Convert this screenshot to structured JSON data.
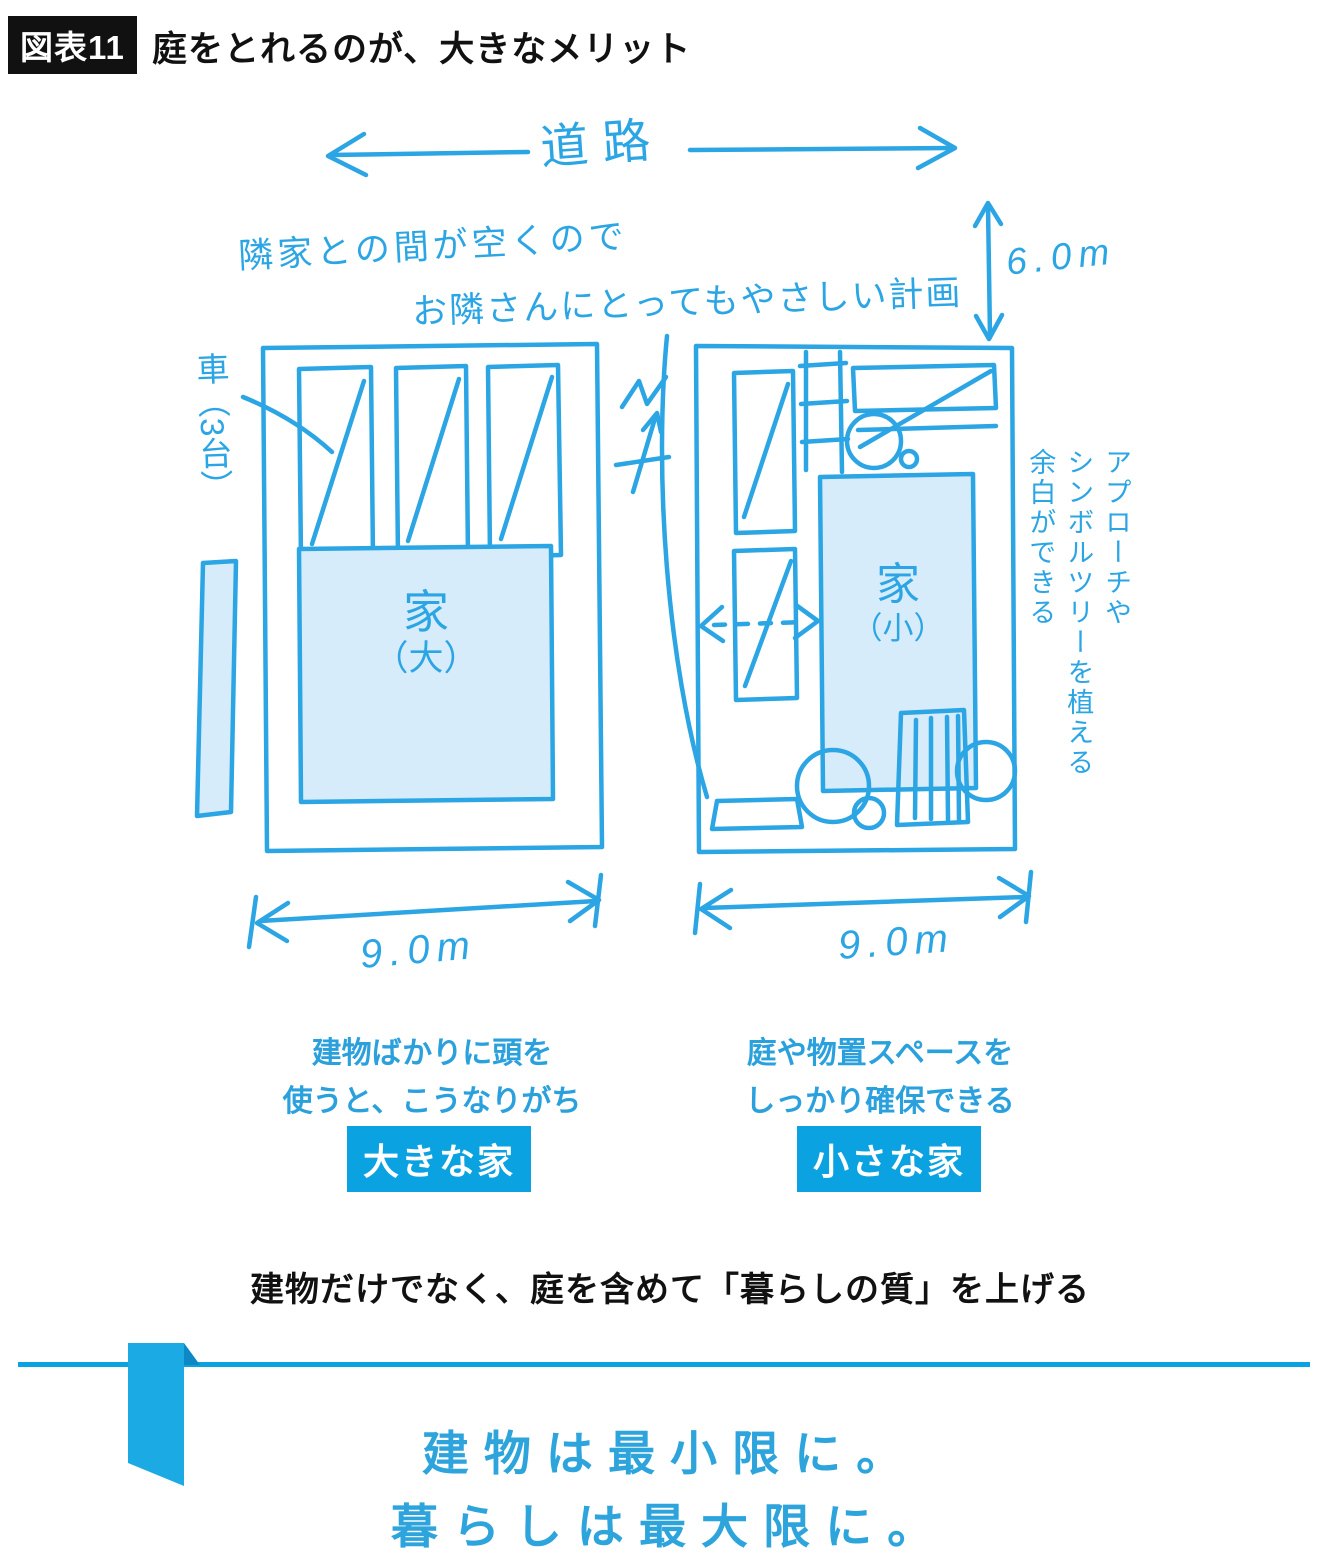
{
  "colors": {
    "sketch_blue": "#2ba5e4",
    "light_fill": "#d7ecfa",
    "accent_blue": "#0aa2e0",
    "text_dark": "#111111"
  },
  "header": {
    "badge": "図表11",
    "title": "庭をとれるのが、大きなメリット"
  },
  "diagram": {
    "road_label": "道路",
    "note_line1": "隣家との間が空くので",
    "note_line2": "お隣さんにとってもやさしい計画",
    "dim_vertical": "6.0m",
    "car_label": "車（3台）",
    "house_large_line1": "家",
    "house_large_line2": "（大）",
    "house_small_line1": "家",
    "house_small_line2": "（小）",
    "side_note_line1": "アプローチや",
    "side_note_line2": "シンボルツリーを植える",
    "side_note_line3": "余白ができる",
    "dim_left": "9.0m",
    "dim_right": "9.0m",
    "caption_left_line1": "建物ばかりに頭を",
    "caption_left_line2": "使うと、こうなりがち",
    "caption_right_line1": "庭や物置スペースを",
    "caption_right_line2": "しっかり確保できる",
    "badge_left": "大きな家",
    "badge_right": "小さな家"
  },
  "summary": "建物だけでなく、庭を含めて「暮らしの質」を上げる",
  "slogan": {
    "line1": "建物は最小限に。",
    "line2": "暮らしは最大限に。"
  }
}
